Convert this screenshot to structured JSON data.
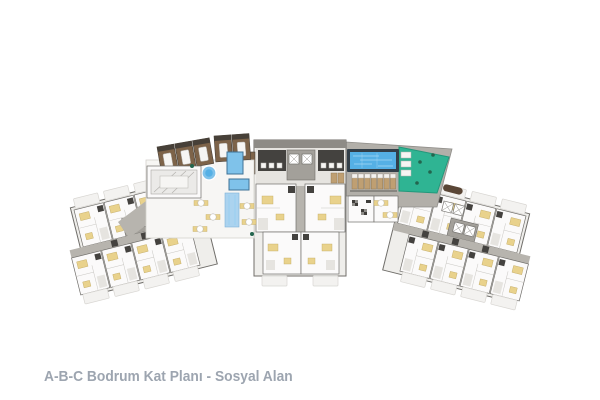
{
  "caption": {
    "text": "A-B-C Bodrum Kat Planı - Sosyal Alan"
  },
  "colors": {
    "page-bg": "#ffffff",
    "caption-text": "#9da5b0",
    "wall": "#706e6a",
    "floor-white": "#fbfafa",
    "floor-shade": "#e6e4e0",
    "wing-base": "#efeeeb",
    "corridor-gray": "#b7b4ae",
    "core-gray": "#a3a09a",
    "band-gray": "#8e8b86",
    "dark-room": "#44423f",
    "ghost-fill": "#f3f2f0",
    "ghost-line": "#d8d6d2",
    "furniture-yellow": "#e9d28c",
    "furniture-yellow-edge": "#c0a860",
    "spa-wood": "#7d6349",
    "spa-wood-dark": "#474038",
    "bed-white": "#f6f5f3",
    "pool-frame": "#333f49",
    "pool-water": "#55b0e5",
    "pool-streak": "#a6d8f4",
    "spa-water": "#7fc2ea",
    "spa-water-edge": "#3f7296",
    "terrace-teal": "#2fb493",
    "terrace-edge": "#23987b",
    "deck-gray": "#b2afa9",
    "sunbed-tan": "#bf9f72",
    "sunbed-white": "#f4f2ef",
    "plant-green": "#23654e",
    "carpet-blue": "#abd3ef",
    "sofa-brown": "#5a4636"
  }
}
